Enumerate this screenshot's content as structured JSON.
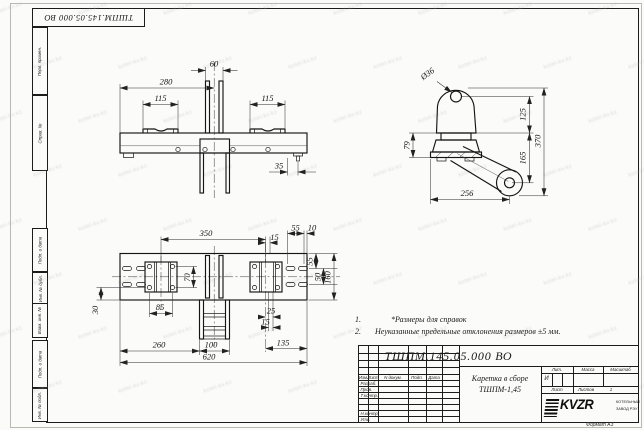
{
  "sheet": {
    "doc_number_top": "ТШПМ.145.05.000  ВО",
    "format_note": "Формат А3",
    "watermark_text": "kotel-kv.kz"
  },
  "side_labels": {
    "perv_primen": "Перв. примен.",
    "sprav_no": "Справ. №",
    "podp_data_1": "Подп. и дата",
    "inv_dubl": "Инв. № дубл.",
    "vzam_inv": "Взам. инв. №",
    "podp_data_2": "Подп. и дата",
    "inv_podl": "Инв. № подл."
  },
  "notes": {
    "item1_no": "1.",
    "item1_text": "*Размеры для справок",
    "item2_no": "2.",
    "item2_text": "Неуказанные предельные отклонения размеров  ±5 мм."
  },
  "dims": {
    "front": {
      "w60": "60",
      "w280": "280",
      "w115_left": "115",
      "w115_right": "115",
      "w35": "35"
    },
    "side": {
      "dia36": "Ø36",
      "h125": "125",
      "h370": "370",
      "h79": "79",
      "h165": "165",
      "w256": "256"
    },
    "plan": {
      "w350": "350",
      "w15_top": "15",
      "w55_top": "55",
      "w10_top": "10",
      "h55_right": "55",
      "h50_right": "50",
      "h160_right": "160",
      "h70": "70",
      "w85": "85",
      "h30": "30",
      "w25": "25",
      "w15_bottom": "15",
      "w135": "135",
      "w260": "260",
      "w100": "100",
      "w620": "620"
    }
  },
  "title_block": {
    "doc_number": "ТШПМ.145.05.000  ВО",
    "product_name_line1": "Каретка в сборе",
    "product_name_line2": "ТШПМ-1,45",
    "col_izm": "Изм.",
    "col_list": "Лист",
    "col_ndoc": "N докум.",
    "col_podp": "Подп.",
    "col_data": "Дата",
    "row_razrab": "Разраб.",
    "row_prov": "Пров.",
    "row_tkontr": "Т.контр.",
    "row_nkontr": "Н.контр.",
    "row_utv": "Утв.",
    "lit_label": "Лит.",
    "lit_value": "И",
    "massa_label": "Масса",
    "masshtab_label": "Масштаб",
    "list_label": "Лист",
    "listov_label": "Листов",
    "listov_value": "1",
    "logo_text": "KVZR",
    "company_line1": "КОТЕЛЬНЫЙ",
    "company_line2": "ЗАВОД РЭУ"
  }
}
